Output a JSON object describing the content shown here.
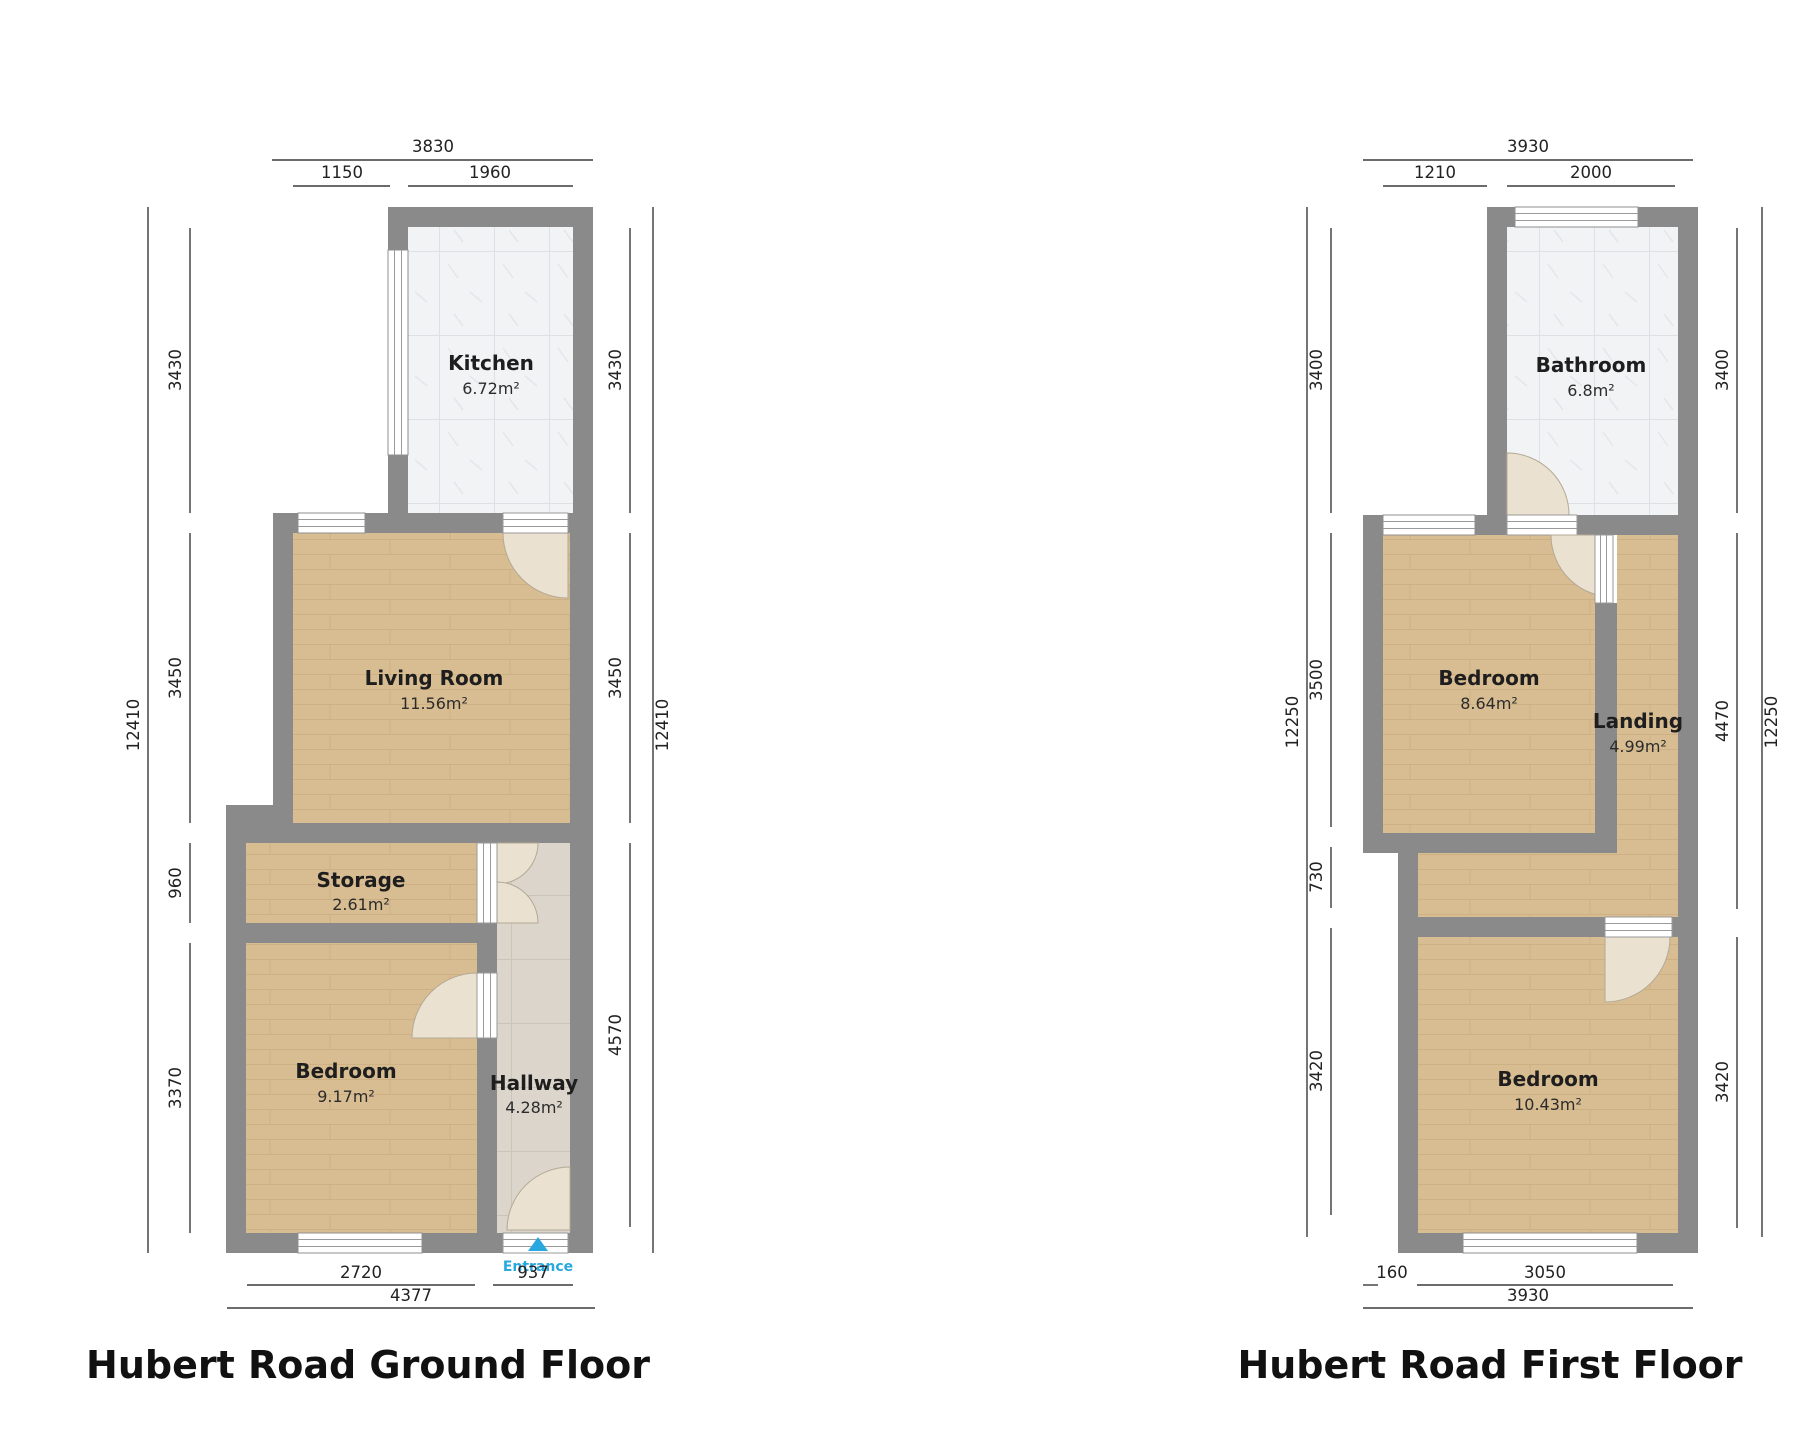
{
  "ground_floor": {
    "title": "Hubert Road Ground Floor",
    "rooms": {
      "kitchen": {
        "name": "Kitchen",
        "area": "6.72m²"
      },
      "living_room": {
        "name": "Living Room",
        "area": "11.56m²"
      },
      "storage": {
        "name": "Storage",
        "area": "2.61m²"
      },
      "bedroom": {
        "name": "Bedroom",
        "area": "9.17m²"
      },
      "hallway": {
        "name": "Hallway",
        "area": "4.28m²"
      }
    },
    "entrance_label": "Entrance",
    "dimensions": {
      "top_total": "3830",
      "top_seg1": "1150",
      "top_seg2": "1960",
      "left_total": "12410",
      "left_seg1": "3430",
      "left_seg2": "3450",
      "left_seg3": "960",
      "left_seg4": "3370",
      "right_total": "12410",
      "right_seg1": "3430",
      "right_seg2": "3450",
      "right_seg3": "4570",
      "bottom_total": "4377",
      "bottom_seg1": "2720",
      "bottom_seg2": "937"
    }
  },
  "first_floor": {
    "title": "Hubert Road First Floor",
    "rooms": {
      "bathroom": {
        "name": "Bathroom",
        "area": "6.8m²"
      },
      "bedroom_front": {
        "name": "Bedroom",
        "area": "8.64m²"
      },
      "landing": {
        "name": "Landing",
        "area": "4.99m²"
      },
      "bedroom_back": {
        "name": "Bedroom",
        "area": "10.43m²"
      }
    },
    "dimensions": {
      "top_total": "3930",
      "top_seg1": "1210",
      "top_seg2": "2000",
      "left_total": "12250",
      "left_seg1": "3400",
      "left_seg2": "3500",
      "left_seg3": "730",
      "left_seg4": "3420",
      "right_total": "12250",
      "right_seg1": "3400",
      "right_seg2": "4470",
      "right_seg3": "3420",
      "bottom_total": "3930",
      "bottom_seg1": "160",
      "bottom_seg2": "3050"
    }
  },
  "colors": {
    "wall": "#8a8a8a",
    "wood_floor": "#d9bd92",
    "tile_floor": "#f1f3f5",
    "hall_floor": "#dbd5cc",
    "entrance_accent": "#29a8e0"
  }
}
